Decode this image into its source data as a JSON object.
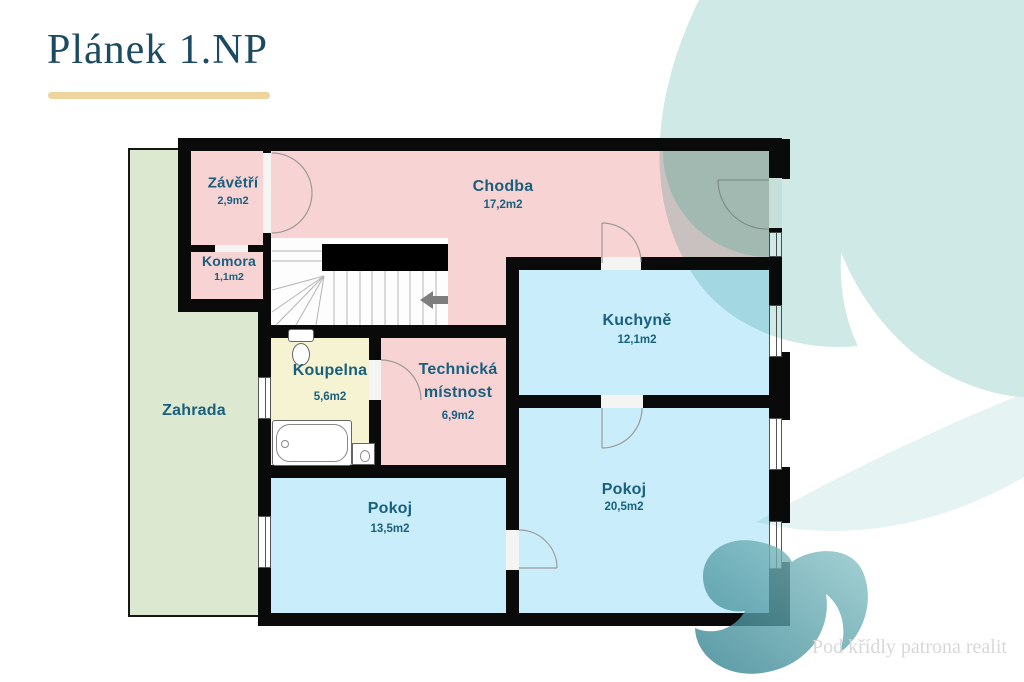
{
  "header": {
    "title": "Plánek 1.NP"
  },
  "watermark": {
    "text": "Pod křídly patrona realit"
  },
  "rooms": {
    "zavetri": {
      "name": "Závětří",
      "area": "2,9m2"
    },
    "komora": {
      "name": "Komora",
      "area": "1,1m2"
    },
    "chodba": {
      "name": "Chodba",
      "area": "17,2m2"
    },
    "kuchyne": {
      "name": "Kuchyně",
      "area": "12,1m2"
    },
    "koupelna": {
      "name": "Koupelna",
      "area": "5,6m2"
    },
    "technicka": {
      "line1": "Technická",
      "line2": "místnost",
      "area": "6,9m2"
    },
    "zahrada": {
      "name": "Zahrada"
    },
    "pokoj_left": {
      "name": "Pokoj",
      "area": "13,5m2"
    },
    "pokoj_right": {
      "name": "Pokoj",
      "area": "20,5m2"
    }
  },
  "colors": {
    "pink": "#f8d3d3",
    "blue": "#c9edfb",
    "yellow": "#f6f3d3",
    "green": "#dce8d0",
    "wall": "#0a0a0a",
    "porch": "#c7cbc4",
    "label": "#19607f",
    "title": "#1d4a63",
    "underline": "#f0d49e",
    "watermark": "#d8d8d8",
    "leaf_light": "#cfe9e7",
    "leaf_dark": "#2f7f8d",
    "leaf_mid": "#8fc8cb",
    "arc": "#9a9a9a"
  }
}
